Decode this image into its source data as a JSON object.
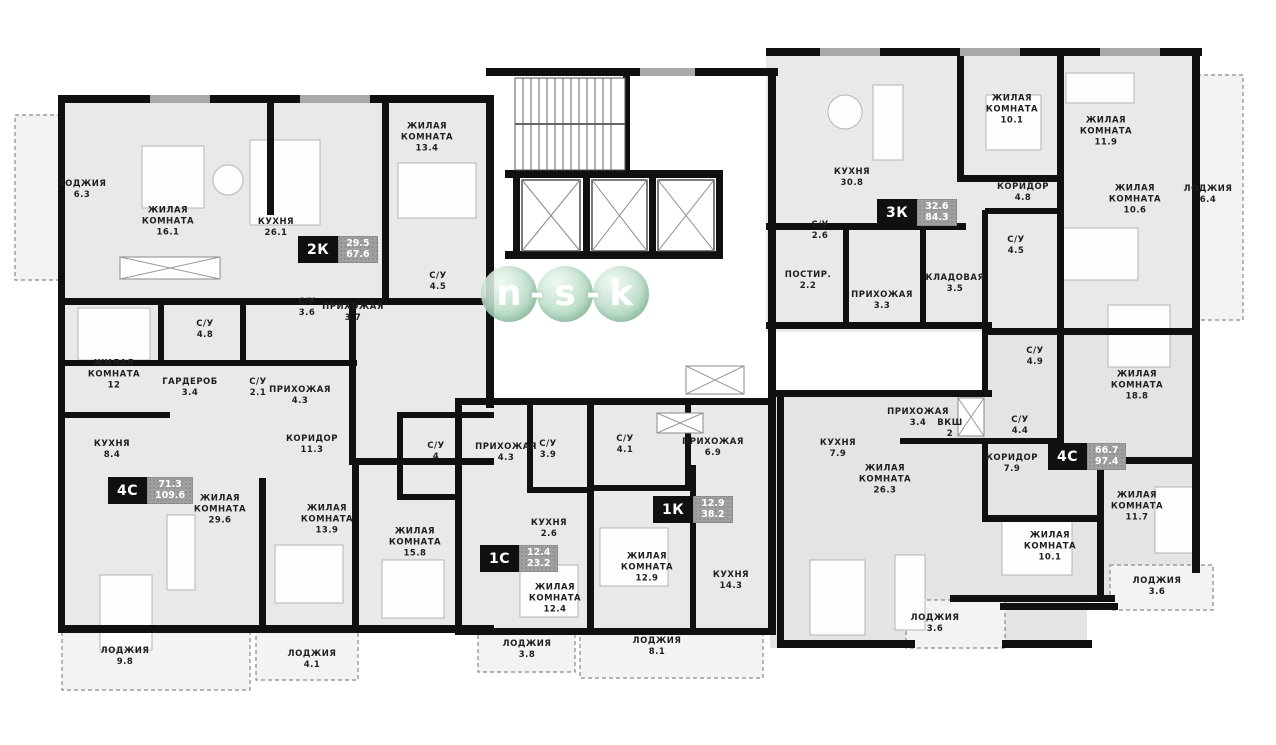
{
  "watermark": {
    "letters": [
      "n",
      "s",
      "k"
    ],
    "separator": "-"
  },
  "apartments": [
    {
      "type": "2К",
      "living_area": "29.5",
      "total_area": "67.6",
      "x": 298,
      "y": 236
    },
    {
      "type": "4С",
      "living_area": "71.3",
      "total_area": "109.6",
      "x": 108,
      "y": 477
    },
    {
      "type": "1С",
      "living_area": "12.4",
      "total_area": "23.2",
      "x": 480,
      "y": 545
    },
    {
      "type": "1К",
      "living_area": "12.9",
      "total_area": "38.2",
      "x": 653,
      "y": 496
    },
    {
      "type": "3К",
      "living_area": "32.6",
      "total_area": "84.3",
      "x": 877,
      "y": 199
    },
    {
      "type": "4С",
      "living_area": "66.7",
      "total_area": "97.4",
      "x": 1048,
      "y": 443
    }
  ],
  "rooms": [
    {
      "name": "ЛОДЖИЯ",
      "area": "6.3",
      "x": 82,
      "y": 190
    },
    {
      "name": "ЖИЛАЯ КОМНАТА",
      "area": "16.1",
      "x": 168,
      "y": 222
    },
    {
      "name": "КУХНЯ",
      "area": "26.1",
      "x": 276,
      "y": 228
    },
    {
      "name": "ЖИЛАЯ КОМНАТА",
      "area": "13.4",
      "x": 427,
      "y": 138
    },
    {
      "name": "С/У",
      "area": "4.5",
      "x": 438,
      "y": 282
    },
    {
      "name": "С/У",
      "area": "3.6",
      "x": 307,
      "y": 308
    },
    {
      "name": "ПРИХОЖАЯ",
      "area": "3.7",
      "x": 353,
      "y": 313
    },
    {
      "name": "С/У",
      "area": "4.8",
      "x": 205,
      "y": 330
    },
    {
      "name": "ЖИЛАЯ КОМНАТА",
      "area": "12",
      "x": 114,
      "y": 375
    },
    {
      "name": "ГАРДЕРОБ",
      "area": "3.4",
      "x": 190,
      "y": 388
    },
    {
      "name": "С/У",
      "area": "2.1",
      "x": 258,
      "y": 388
    },
    {
      "name": "ПРИХОЖАЯ",
      "area": "4.3",
      "x": 300,
      "y": 396
    },
    {
      "name": "КУХНЯ",
      "area": "8.4",
      "x": 112,
      "y": 450
    },
    {
      "name": "КОРИДОР",
      "area": "11.3",
      "x": 312,
      "y": 445
    },
    {
      "name": "С/У",
      "area": "4",
      "x": 436,
      "y": 452
    },
    {
      "name": "ЖИЛАЯ КОМНАТА",
      "area": "29.6",
      "x": 220,
      "y": 510
    },
    {
      "name": "ЖИЛАЯ КОМНАТА",
      "area": "13.9",
      "x": 327,
      "y": 520
    },
    {
      "name": "ЖИЛАЯ КОМНАТА",
      "area": "15.8",
      "x": 415,
      "y": 543
    },
    {
      "name": "ЛОДЖИЯ",
      "area": "9.8",
      "x": 125,
      "y": 657
    },
    {
      "name": "ЛОДЖИЯ",
      "area": "4.1",
      "x": 312,
      "y": 660
    },
    {
      "name": "ПРИХОЖАЯ",
      "area": "4.3",
      "x": 506,
      "y": 453
    },
    {
      "name": "С/У",
      "area": "3.9",
      "x": 548,
      "y": 450
    },
    {
      "name": "КУХНЯ",
      "area": "2.6",
      "x": 549,
      "y": 529
    },
    {
      "name": "ЖИЛАЯ КОМНАТА",
      "area": "12.4",
      "x": 555,
      "y": 599
    },
    {
      "name": "ЛОДЖИЯ",
      "area": "3.8",
      "x": 527,
      "y": 650
    },
    {
      "name": "С/У",
      "area": "4.1",
      "x": 625,
      "y": 445
    },
    {
      "name": "ПРИХОЖАЯ",
      "area": "6.9",
      "x": 713,
      "y": 448
    },
    {
      "name": "ЖИЛАЯ КОМНАТА",
      "area": "12.9",
      "x": 647,
      "y": 568
    },
    {
      "name": "КУХНЯ",
      "area": "14.3",
      "x": 731,
      "y": 581
    },
    {
      "name": "ЛОДЖИЯ",
      "area": "8.1",
      "x": 657,
      "y": 647
    },
    {
      "name": "КУХНЯ",
      "area": "30.8",
      "x": 852,
      "y": 178
    },
    {
      "name": "ЖИЛАЯ КОМНАТА",
      "area": "10.1",
      "x": 1012,
      "y": 110
    },
    {
      "name": "ЖИЛАЯ КОМНАТА",
      "area": "11.9",
      "x": 1106,
      "y": 132
    },
    {
      "name": "КОРИДОР",
      "area": "4.8",
      "x": 1023,
      "y": 193
    },
    {
      "name": "ЖИЛАЯ КОМНАТА",
      "area": "10.6",
      "x": 1135,
      "y": 200
    },
    {
      "name": "ЛОДЖИЯ",
      "area": "6.4",
      "x": 1208,
      "y": 195
    },
    {
      "name": "С/У",
      "area": "2.6",
      "x": 820,
      "y": 231
    },
    {
      "name": "ПОСТИР.",
      "area": "2.2",
      "x": 808,
      "y": 281
    },
    {
      "name": "ПРИХОЖАЯ",
      "area": "3.3",
      "x": 882,
      "y": 301
    },
    {
      "name": "КЛАДОВАЯ",
      "area": "3.5",
      "x": 955,
      "y": 284
    },
    {
      "name": "С/У",
      "area": "4.5",
      "x": 1016,
      "y": 246
    },
    {
      "name": "С/У",
      "area": "4.9",
      "x": 1035,
      "y": 357
    },
    {
      "name": "ЖИЛАЯ КОМНАТА",
      "area": "18.8",
      "x": 1137,
      "y": 386
    },
    {
      "name": "ПРИХОЖАЯ",
      "area": "3.4",
      "x": 918,
      "y": 418
    },
    {
      "name": "ВКШ",
      "area": "2",
      "x": 950,
      "y": 429
    },
    {
      "name": "С/У",
      "area": "4.4",
      "x": 1020,
      "y": 426
    },
    {
      "name": "КУХНЯ",
      "area": "7.9",
      "x": 838,
      "y": 449
    },
    {
      "name": "КОРИДОР",
      "area": "7.9",
      "x": 1012,
      "y": 464
    },
    {
      "name": "ЖИЛАЯ КОМНАТА",
      "area": "26.3",
      "x": 885,
      "y": 480
    },
    {
      "name": "ЖИЛАЯ КОМНАТА",
      "area": "11.7",
      "x": 1137,
      "y": 507
    },
    {
      "name": "ЖИЛАЯ КОМНАТА",
      "area": "10.1",
      "x": 1050,
      "y": 547
    },
    {
      "name": "ЛОДЖИЯ",
      "area": "3.6",
      "x": 935,
      "y": 624
    },
    {
      "name": "ЛОДЖИЯ",
      "area": "3.6",
      "x": 1157,
      "y": 587
    }
  ]
}
